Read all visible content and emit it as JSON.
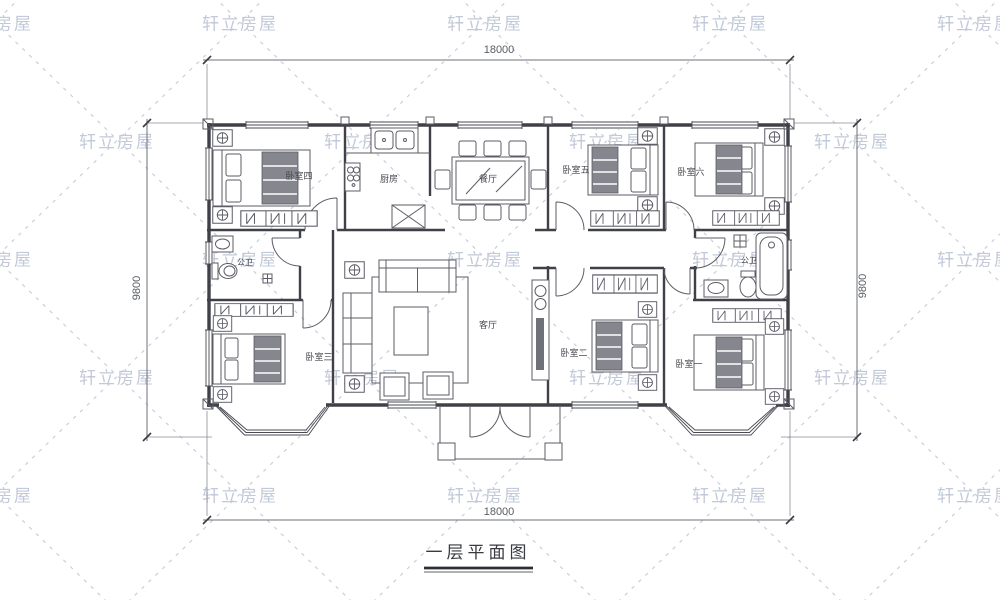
{
  "watermark": {
    "text": "轩立房屋"
  },
  "plan": {
    "title": "一层平面图",
    "dim_top": "18000",
    "dim_bottom": "18000",
    "dim_left": "9800",
    "dim_right": "9800",
    "rooms": {
      "bedroom4": "卧室四",
      "kitchen": "厨房",
      "dining": "餐厅",
      "bedroom5": "卧室五",
      "bedroom6": "卧室六",
      "bath_left": "公卫",
      "bath_right": "公卫",
      "living": "客厅",
      "bedroom3": "卧室三",
      "bedroom2": "卧室二",
      "bedroom1": "卧室一"
    },
    "colors": {
      "wall": "#3f4048",
      "furniture": "#5c5d66",
      "watermark": "#c2c9d8",
      "dimension": "#585d63"
    }
  }
}
